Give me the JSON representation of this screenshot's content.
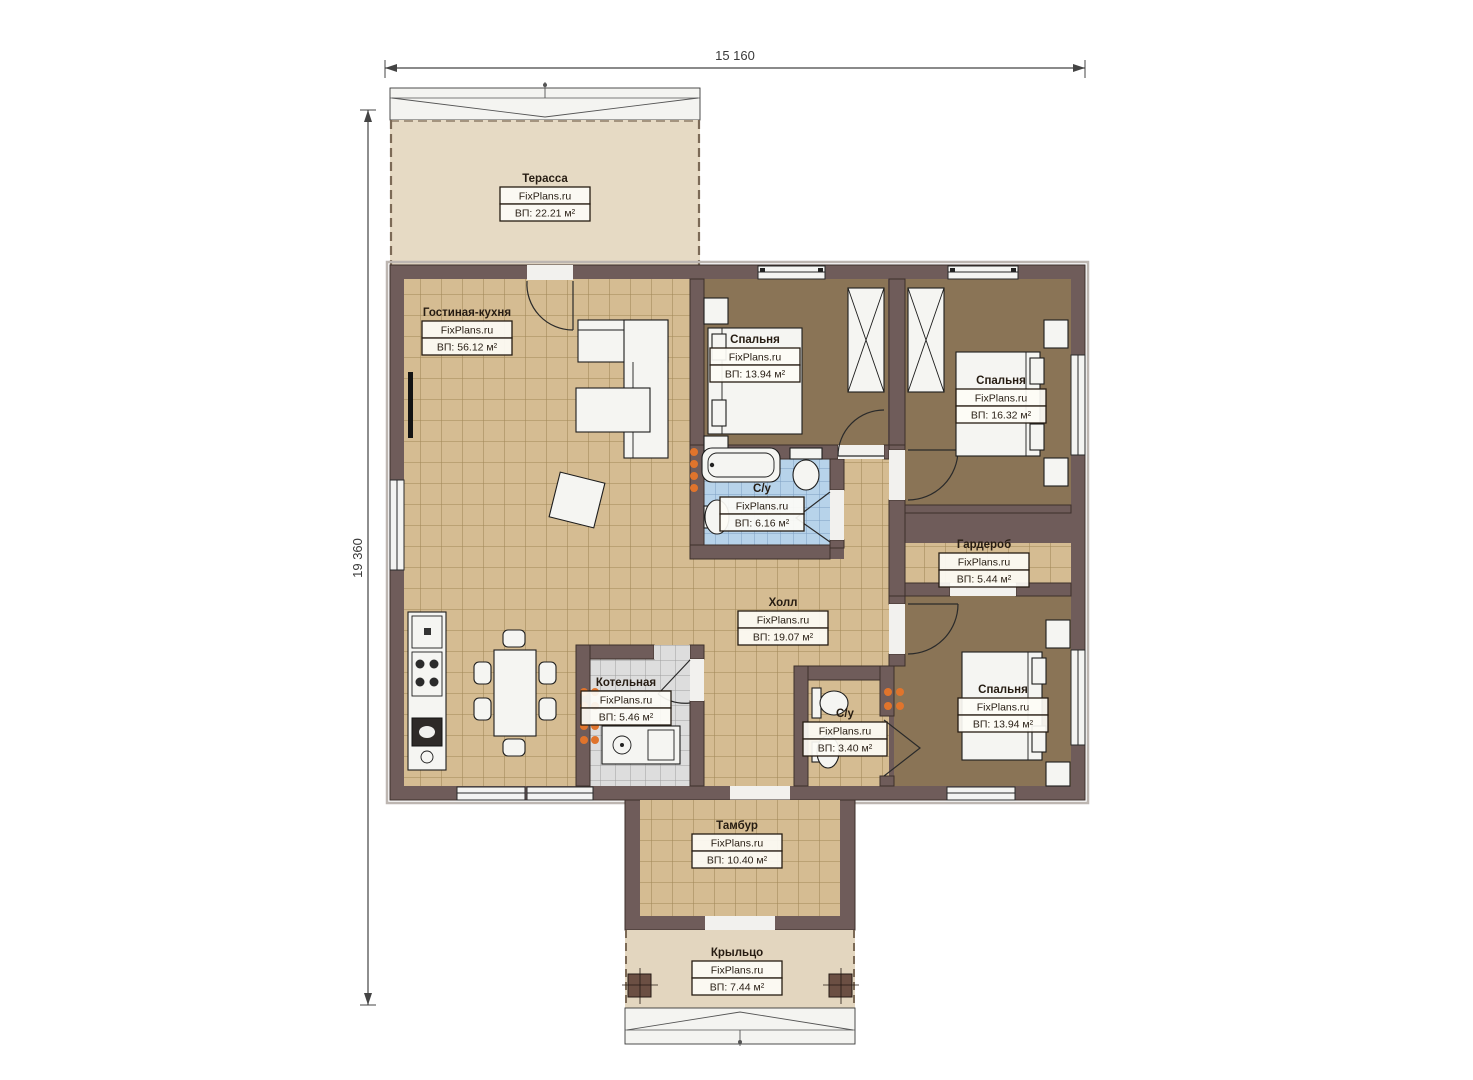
{
  "dimensions": {
    "width_label": "15 160",
    "height_label": "19 360"
  },
  "watermark": "FixPlans.ru",
  "rooms": [
    {
      "name": "Терасса",
      "brand": "FixPlans.ru",
      "area": "ВП: 22.21 м²"
    },
    {
      "name": "Гостиная-кухня",
      "brand": "FixPlans.ru",
      "area": "ВП: 56.12 м²"
    },
    {
      "name": "Спальня",
      "brand": "FixPlans.ru",
      "area": "ВП: 13.94 м²"
    },
    {
      "name": "Спальня",
      "brand": "FixPlans.ru",
      "area": "ВП: 16.32 м²"
    },
    {
      "name": "С/у",
      "brand": "FixPlans.ru",
      "area": "ВП: 6.16 м²"
    },
    {
      "name": "Гардероб",
      "brand": "FixPlans.ru",
      "area": "ВП: 5.44 м²"
    },
    {
      "name": "Холл",
      "brand": "FixPlans.ru",
      "area": "ВП: 19.07 м²"
    },
    {
      "name": "Котельная",
      "brand": "FixPlans.ru",
      "area": "ВП: 5.46 м²"
    },
    {
      "name": "С/у",
      "brand": "FixPlans.ru",
      "area": "ВП: 3.40 м²"
    },
    {
      "name": "Спальня",
      "brand": "FixPlans.ru",
      "area": "ВП: 13.94 м²"
    },
    {
      "name": "Тамбур",
      "brand": "FixPlans.ru",
      "area": "ВП: 10.40 м²"
    },
    {
      "name": "Крыльцо",
      "brand": "FixPlans.ru",
      "area": "ВП: 7.44 м²"
    }
  ],
  "colors": {
    "wall": "#6f5c5a",
    "floor_tile_tan": "#d5bc92",
    "floor_bedroom_brown": "#8a7456",
    "floor_bath_blue": "#b7d3ea",
    "floor_boiler_gray": "#dddddd",
    "terrace_beige": "#e6dac4",
    "radiator_orange": "#e0742c",
    "label_ink": "#261c12"
  }
}
